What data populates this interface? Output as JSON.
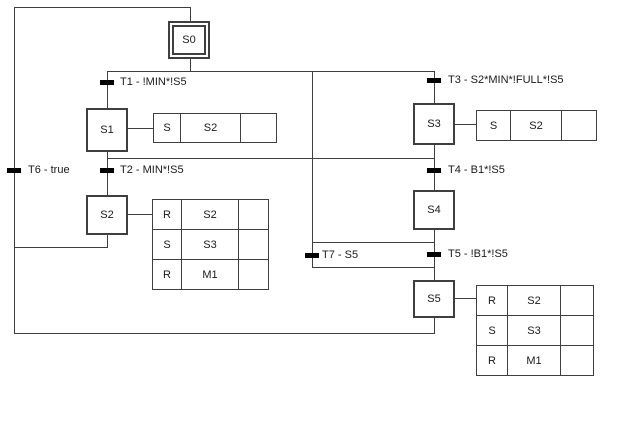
{
  "diagram_type": "sequential-function-chart",
  "colors": {
    "background": "#ffffff",
    "line": "#3f3f3f",
    "transition_tick": "#000000",
    "text": "#1a1a1a"
  },
  "steps": {
    "s0": {
      "label": "S0",
      "initial": true
    },
    "s1": {
      "label": "S1"
    },
    "s2": {
      "label": "S2"
    },
    "s3": {
      "label": "S3"
    },
    "s4": {
      "label": "S4"
    },
    "s5": {
      "label": "S5"
    }
  },
  "transitions": {
    "t1": "T1 - !MIN*!S5",
    "t2": "T2 - MIN*!S5",
    "t3": "T3 - S2*MIN*!FULL*!S5",
    "t4": "T4 - B1*!S5",
    "t5": "T5 - !B1*!S5",
    "t6": "T6 - true",
    "t7": "T7 - S5"
  },
  "action_blocks": {
    "s1": {
      "rows": [
        [
          "S",
          "S2",
          ""
        ]
      ]
    },
    "s2": {
      "rows": [
        [
          "R",
          "S2",
          ""
        ],
        [
          "S",
          "S3",
          ""
        ],
        [
          "R",
          "M1",
          ""
        ]
      ]
    },
    "s3": {
      "rows": [
        [
          "S",
          "S2",
          ""
        ]
      ]
    },
    "s5": {
      "rows": [
        [
          "R",
          "S2",
          ""
        ],
        [
          "S",
          "S3",
          ""
        ],
        [
          "R",
          "M1",
          ""
        ]
      ]
    }
  }
}
